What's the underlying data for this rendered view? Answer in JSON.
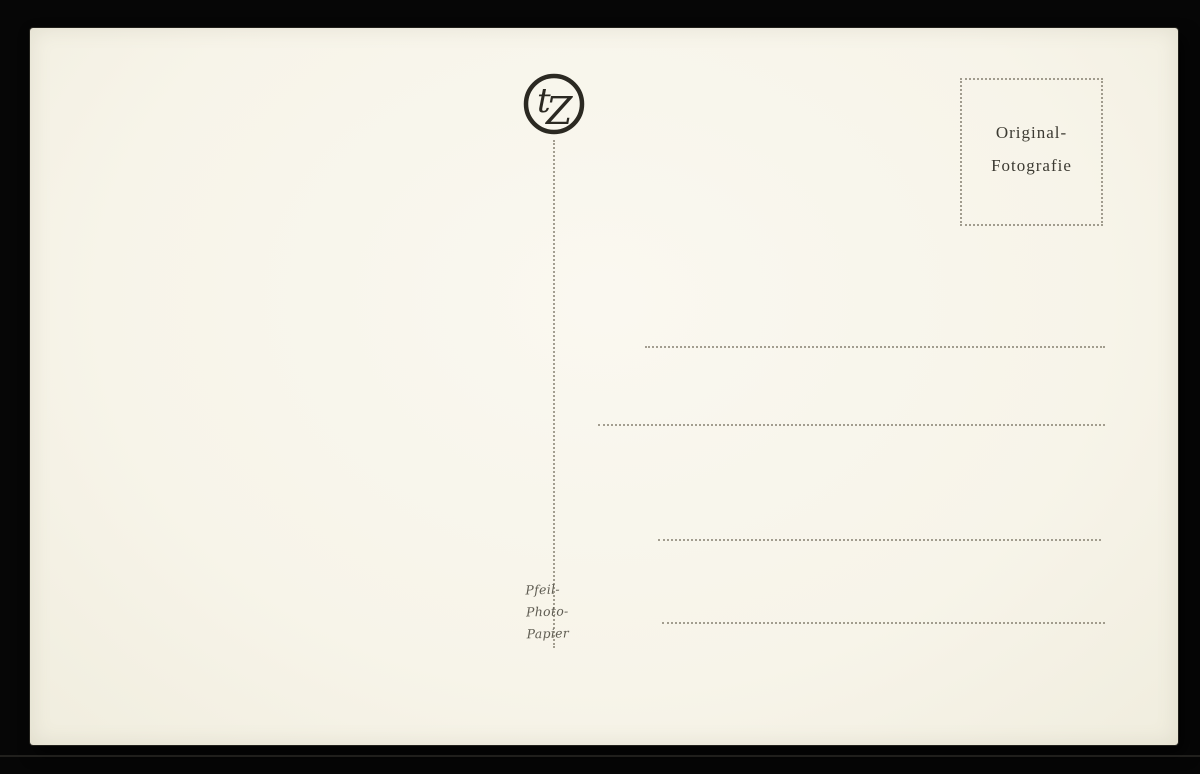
{
  "colors": {
    "backdrop": "#060606",
    "card": "#f7f4e9",
    "ink": "#2b2922",
    "stamp_ink": "#3c3a32",
    "dotted_line": "rgba(105,98,82,0.6)",
    "imprint_ink": "#5f5c52"
  },
  "logo": {
    "letter_left": "t",
    "letter_right": "Z"
  },
  "stamp_box": {
    "line1": "Original-",
    "line2": "Fotografie"
  },
  "imprint": {
    "lines": [
      "Pfeil-",
      "Photo-",
      "Papier"
    ]
  },
  "address_lines": {
    "count": 4
  }
}
